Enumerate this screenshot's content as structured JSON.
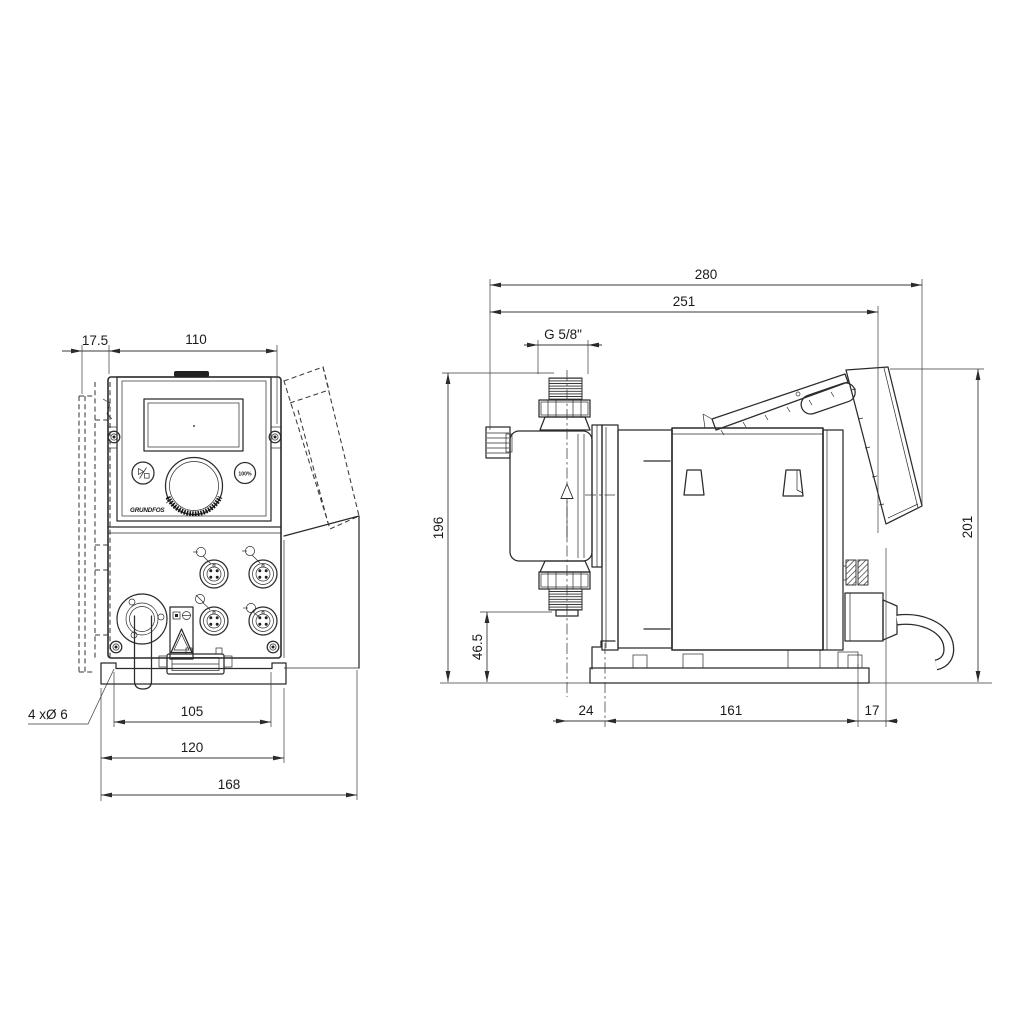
{
  "front_view": {
    "dimensions": {
      "bracket_offset": "17.5",
      "housing_width": "110",
      "hole_spacing": "105",
      "plate_width": "120",
      "overall_width": "168",
      "mounting_holes": "4 xØ 6"
    },
    "panel": {
      "capacity_button": "100%",
      "logo": "GRUNDFOS"
    }
  },
  "side_view": {
    "dimensions": {
      "overall_depth": "280",
      "depth_to_hood": "251",
      "connection_thread": "G 5/8\"",
      "height_to_connection": "196",
      "outlet_height": "46.5",
      "front_overhang": "24",
      "plate_depth": "161",
      "rear_overhang": "17",
      "overall_height": "201"
    }
  },
  "colors": {
    "line": "#2b2b2b",
    "dimension": "#3a3a3a",
    "background": "#ffffff"
  }
}
